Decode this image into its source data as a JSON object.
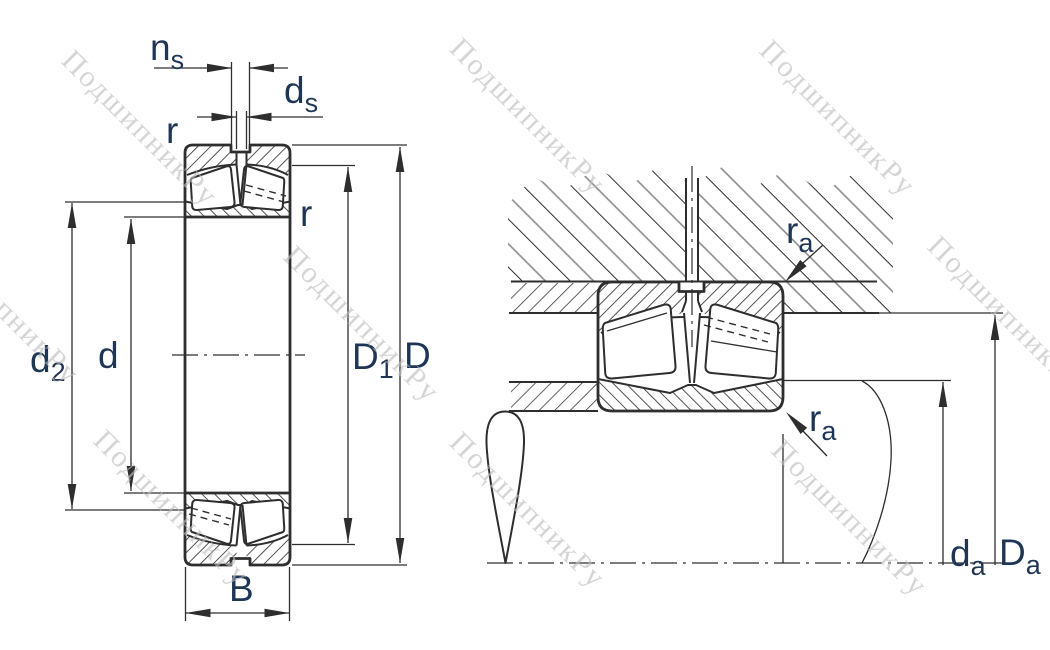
{
  "watermark": {
    "text": "ПодшипникРу"
  },
  "left_view": {
    "dim_ns": {
      "main": "n",
      "sub": "s"
    },
    "dim_ds": {
      "main": "d",
      "sub": "s"
    },
    "dim_r_outer": "r",
    "dim_r_inner": "r",
    "dim_d2": {
      "main": "d",
      "sub": "2"
    },
    "dim_d": "d",
    "dim_D1": {
      "main": "D",
      "sub": "1"
    },
    "dim_D": "D",
    "dim_B": "B"
  },
  "right_view": {
    "dim_ra_housing": {
      "main": "r",
      "sub": "a"
    },
    "dim_ra_shaft": {
      "main": "r",
      "sub": "a"
    },
    "dim_da": {
      "main": "d",
      "sub": "a"
    },
    "dim_Da": {
      "main": "D",
      "sub": "a"
    }
  },
  "colors": {
    "line": "#2e2e2e",
    "label": "#1f3556",
    "watermark": "#bcbcbc",
    "background": "#ffffff"
  }
}
